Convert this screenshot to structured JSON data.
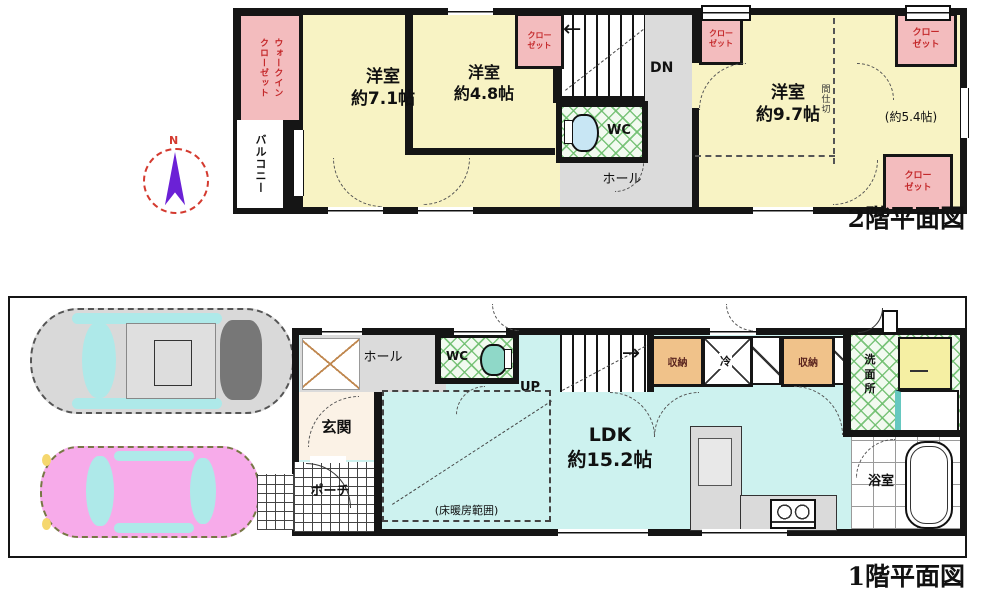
{
  "document": {
    "type": "real-estate-floorplan"
  },
  "compass": {
    "north": "N"
  },
  "floor2": {
    "caption": "2階平面図",
    "walk_in_closet": "ウォークイン\nクローゼット",
    "balcony": "バルコニー",
    "room_7_1": "洋室\n約7.1帖",
    "room_4_8": "洋室\n約4.8帖",
    "room_9_7": "洋室\n約9.7帖",
    "room_5_4": "(約5.4帖)",
    "closet": "クロー\nゼット",
    "wc": "WC",
    "hall": "ホール",
    "down": "DN",
    "partition": "間仕切"
  },
  "floor1": {
    "caption": "1階平面図",
    "entrance": "玄関",
    "hall": "ホール",
    "wc": "WC",
    "up": "UP",
    "ldk": "LDK\n約15.2帖",
    "floor_heating": "(床暖房範囲)",
    "storage": "収納",
    "refrigerator": "冷",
    "washroom": "洗\n面\n所",
    "bathroom": "浴室",
    "porch": "ポーチ"
  },
  "colors": {
    "wall": "#151515",
    "room_yellow": "#F8F3C4",
    "closet_pink": "#F3BCBE",
    "closet_text_red": "#C4292B",
    "ldk_cyan": "#CDF2EF",
    "hall_gray": "#DBDBDB",
    "storage_orange": "#F0C28A",
    "tile_green": "#6EBE6E",
    "washer_yellow": "#F5EFA3",
    "car_gray": "#D9D9D9",
    "car_pink": "#F7ABEA",
    "window_cyan": "#AEE9E9",
    "compass_purple": "#6B21D6",
    "compass_red": "#D43A2F"
  }
}
